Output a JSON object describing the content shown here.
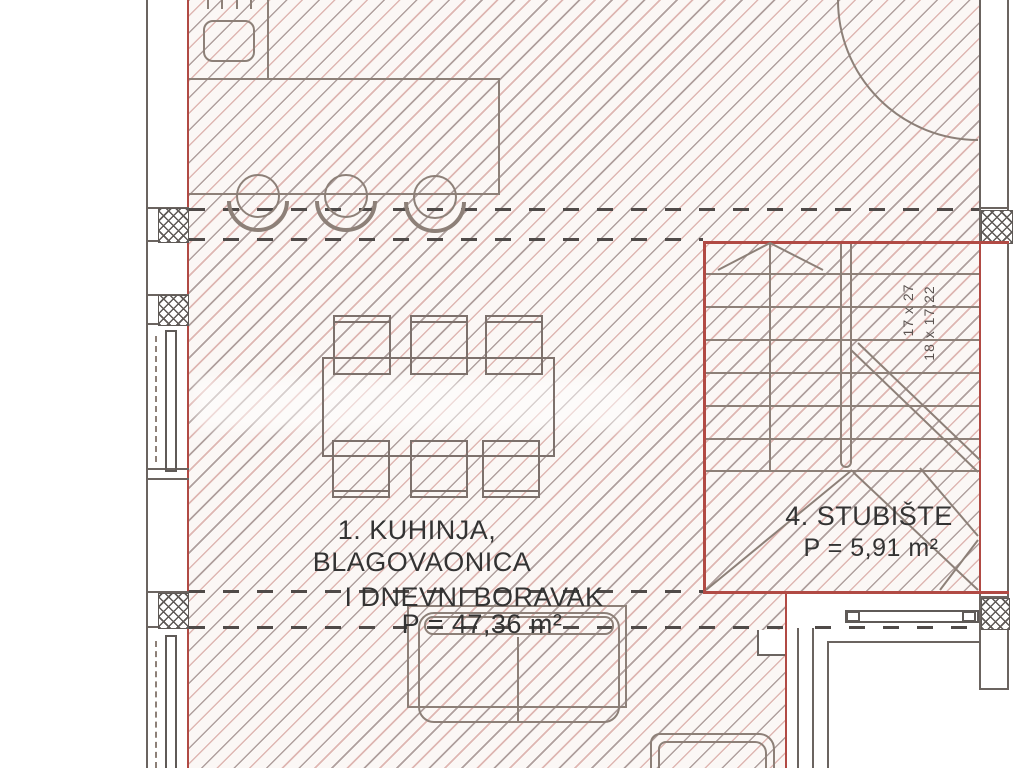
{
  "plan": {
    "title": "floor-plan-kitchen-living-staircase",
    "room_living": {
      "line1": "1. KUHINJA,",
      "line2": "BLAGOVAONICA",
      "line3": "I DNEVNI BORAVAK",
      "area": "P = 47,36 m²"
    },
    "staircase": {
      "label": "4. STUBIŠTE",
      "area": "P = 5,91 m²",
      "tread_note": "17 x 27",
      "riser_note": "18 x 17,22"
    }
  },
  "colors": {
    "wall_red": "#b14a44",
    "furniture_gray": "#8d8078",
    "section_dark": "#5f5a57",
    "hatch_gray": "#b5a8a5",
    "hatch_pink": "#d8b2ad",
    "text": "#333333"
  }
}
